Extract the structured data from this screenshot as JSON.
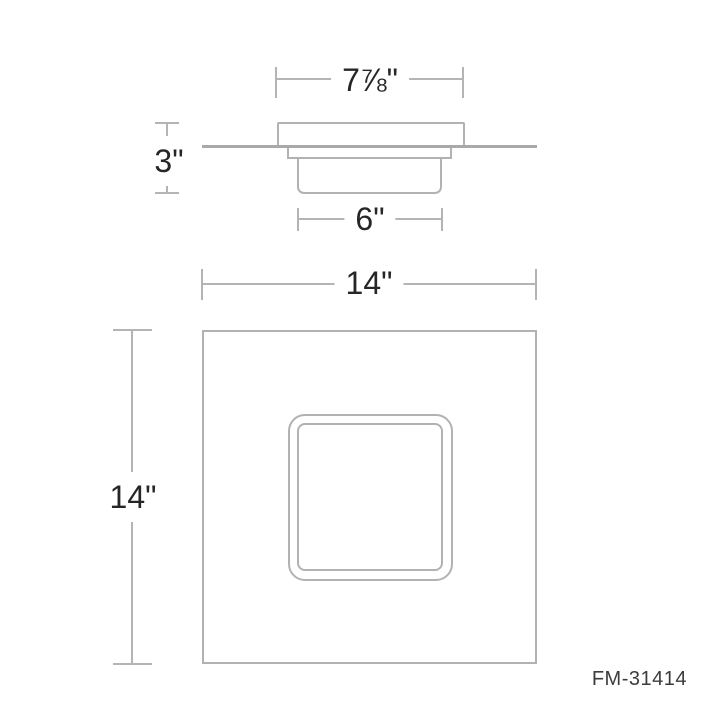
{
  "drawing": {
    "part_number": "FM-31414",
    "dimensions": {
      "canopy_width": "7⅞\"",
      "fixture_height": "3\"",
      "body_width": "6\"",
      "overall_width": "14\"",
      "overall_height": "14\""
    },
    "colors": {
      "line": "#b4b4b4",
      "ceiling_line": "#a9a9a9",
      "text": "#262626"
    }
  }
}
